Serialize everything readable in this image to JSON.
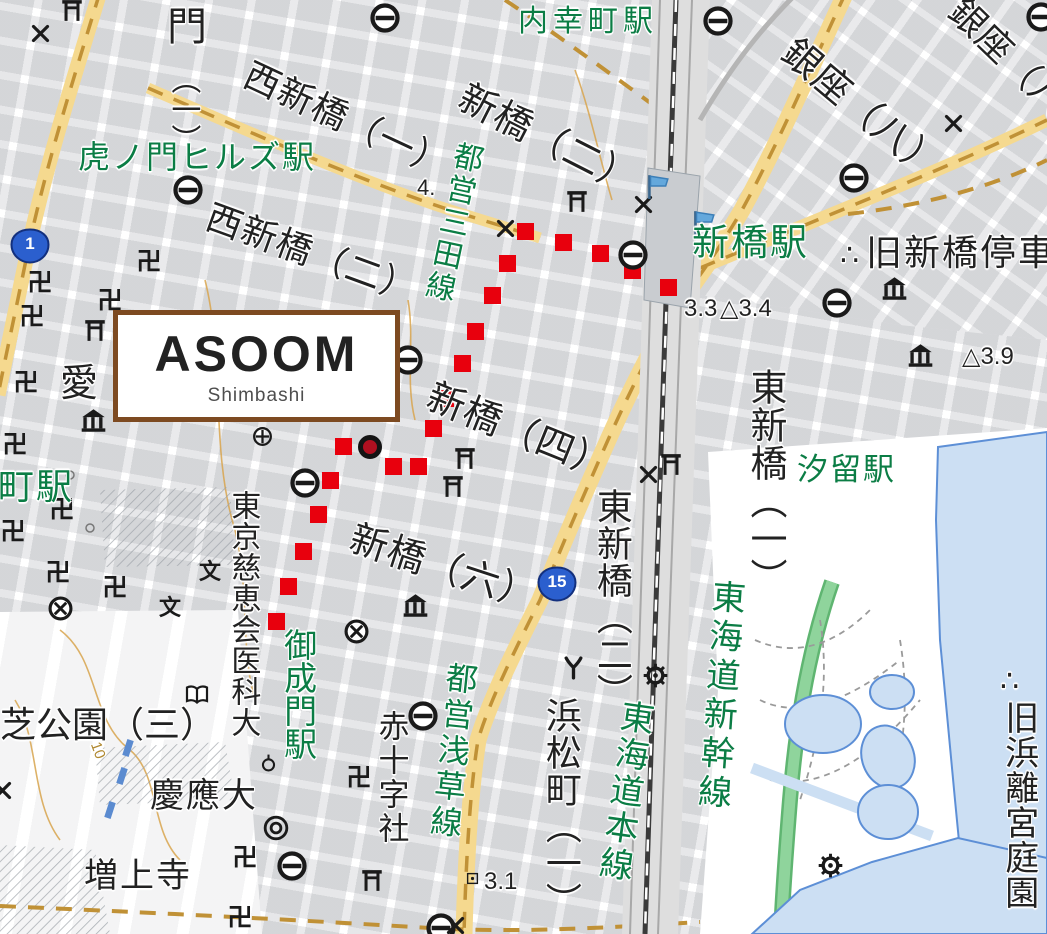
{
  "map": {
    "overlay_card": {
      "title": "ASOOM",
      "subtitle": "Shimbashi"
    },
    "colors": {
      "station_green": "#0b7d45",
      "route_red": "#e8000d",
      "marker_red": "#b01020",
      "road_yellow": "#f5d98f",
      "road_dash_brown": "#c09136",
      "water_fill": "#ccdff3",
      "water_line": "#5d8fd6",
      "green_ribbon": "#8fd49c",
      "box_brown": "#7d4a21",
      "rail_gray": "#dedede"
    },
    "route_shields": [
      {
        "number": "1",
        "x": 10,
        "y": 228
      },
      {
        "number": "15",
        "x": 537,
        "y": 566
      }
    ],
    "destination_marker": {
      "x": 370,
      "y": 447
    },
    "route_dots": [
      [
        668,
        287
      ],
      [
        632,
        270
      ],
      [
        600,
        253
      ],
      [
        563,
        242
      ],
      [
        525,
        231
      ],
      [
        507,
        263
      ],
      [
        492,
        295
      ],
      [
        475,
        331
      ],
      [
        462,
        363
      ],
      [
        445,
        398
      ],
      [
        433,
        428
      ],
      [
        418,
        466
      ],
      [
        393,
        466
      ],
      [
        343,
        446
      ],
      [
        330,
        480
      ],
      [
        318,
        514
      ],
      [
        303,
        551
      ],
      [
        288,
        586
      ],
      [
        276,
        621
      ]
    ],
    "labels": [
      {
        "t": "内幸町駅",
        "x": 518,
        "y": 6,
        "d": "h",
        "s": 30,
        "c": "g",
        "r": 0,
        "ls": 5
      },
      {
        "t": "虎ノ門ヒルズ駅",
        "x": 78,
        "y": 140,
        "d": "h",
        "s": 32,
        "c": "g",
        "r": 0,
        "ls": 2
      },
      {
        "t": "新橋駅",
        "x": 692,
        "y": 223,
        "d": "h",
        "s": 37,
        "c": "g",
        "r": 0,
        "ls": 2
      },
      {
        "t": "汐留駅",
        "x": 797,
        "y": 453,
        "d": "h",
        "s": 31,
        "c": "g",
        "r": 0,
        "ls": 2
      },
      {
        "t": "御成門駅",
        "x": 280,
        "y": 628,
        "d": "v",
        "s": 33,
        "c": "g",
        "r": 0,
        "ls": 0
      },
      {
        "t": "都営三田線",
        "x": 452,
        "y": 138,
        "d": "v",
        "s": 30,
        "c": "g",
        "r": 12,
        "ls": 3
      },
      {
        "t": "都営浅草線",
        "x": 444,
        "y": 660,
        "d": "v",
        "s": 32,
        "c": "g",
        "r": 6,
        "ls": 4
      },
      {
        "t": "東海道新幹線",
        "x": 708,
        "y": 578,
        "d": "v",
        "s": 34,
        "c": "g",
        "r": 4,
        "ls": 5
      },
      {
        "t": "東海道本線",
        "x": 618,
        "y": 697,
        "d": "v",
        "s": 34,
        "c": "g",
        "r": 8,
        "ls": 3
      },
      {
        "t": "町駅",
        "x": -2,
        "y": 468,
        "d": "h",
        "s": 36,
        "c": "g",
        "r": 0,
        "ls": 2
      },
      {
        "t": "門",
        "x": 167,
        "y": 6,
        "d": "h",
        "s": 40,
        "c": "k",
        "r": 0,
        "ls": 0
      },
      {
        "t": "（一）",
        "x": 166,
        "y": 64,
        "d": "v",
        "s": 30,
        "c": "k",
        "r": 0,
        "ls": 0
      },
      {
        "t": "西新橋（一）",
        "x": 254,
        "y": 56,
        "d": "h",
        "s": 36,
        "c": "k",
        "r": 25,
        "ls": 1
      },
      {
        "t": "西新橋（二）",
        "x": 214,
        "y": 198,
        "d": "h",
        "s": 36,
        "c": "k",
        "r": 20,
        "ls": 1
      },
      {
        "t": "新橋（二）",
        "x": 470,
        "y": 78,
        "d": "h",
        "s": 38,
        "c": "k",
        "r": 27,
        "ls": 1
      },
      {
        "t": "新橋（四）",
        "x": 436,
        "y": 377,
        "d": "h",
        "s": 38,
        "c": "k",
        "r": 22,
        "ls": 1
      },
      {
        "t": "新橋（六）",
        "x": 357,
        "y": 519,
        "d": "h",
        "s": 38,
        "c": "k",
        "r": 18,
        "ls": 1
      },
      {
        "t": "東新橋（一）",
        "x": 745,
        "y": 368,
        "d": "v",
        "s": 37,
        "c": "k",
        "r": 0,
        "ls": 1
      },
      {
        "t": "東新橋（二）",
        "x": 592,
        "y": 488,
        "d": "v",
        "s": 36,
        "c": "k",
        "r": 0,
        "ls": 1
      },
      {
        "t": "浜松町（一）",
        "x": 541,
        "y": 697,
        "d": "v",
        "s": 36,
        "c": "k",
        "r": 0,
        "ls": 1
      },
      {
        "t": "東京慈恵会医科大",
        "x": 226,
        "y": 490,
        "d": "v",
        "s": 30,
        "c": "k",
        "r": 0,
        "ls": 1
      },
      {
        "t": "芝公園（三）",
        "x": 0,
        "y": 706,
        "d": "h",
        "s": 36,
        "c": "k",
        "r": 0,
        "ls": 0
      },
      {
        "t": "慶應大",
        "x": 150,
        "y": 778,
        "d": "h",
        "s": 34,
        "c": "k",
        "r": 0,
        "ls": 2
      },
      {
        "t": "増上寺",
        "x": 84,
        "y": 858,
        "d": "h",
        "s": 34,
        "c": "k",
        "r": 0,
        "ls": 2
      },
      {
        "t": "赤十字社",
        "x": 374,
        "y": 710,
        "d": "v",
        "s": 31,
        "c": "k",
        "r": 0,
        "ls": 3
      },
      {
        "t": "銀座（八）",
        "x": 800,
        "y": 32,
        "d": "h",
        "s": 38,
        "c": "k",
        "r": 40,
        "ls": 1
      },
      {
        "t": "銀座（八）",
        "x": 968,
        "y": -8,
        "d": "h",
        "s": 36,
        "c": "k",
        "r": 44,
        "ls": 1
      },
      {
        "t": "愛",
        "x": 60,
        "y": 364,
        "d": "h",
        "s": 38,
        "c": "k",
        "r": 0,
        "ls": 0
      },
      {
        "t": "∴",
        "x": 840,
        "y": 240,
        "d": "h",
        "s": 30,
        "c": "k",
        "r": 0,
        "ls": 0
      },
      {
        "t": "旧新橋停車",
        "x": 866,
        "y": 234,
        "d": "h",
        "s": 36,
        "c": "k",
        "r": 0,
        "ls": 2
      },
      {
        "t": "∴",
        "x": 1000,
        "y": 666,
        "d": "h",
        "s": 30,
        "c": "k",
        "r": 0,
        "ls": 0
      },
      {
        "t": "旧浜離宮庭園",
        "x": 1000,
        "y": 700,
        "d": "v",
        "s": 34,
        "c": "k",
        "r": 0,
        "ls": 1
      },
      {
        "t": "浜松町",
        "x": 995,
        "y": 940,
        "d": "h",
        "s": 1,
        "c": "k",
        "r": 0,
        "ls": 0
      },
      {
        "t": "4.",
        "x": 417,
        "y": 176,
        "d": "h",
        "s": 22,
        "c": "k",
        "r": 0,
        "ls": 0
      },
      {
        "t": "3.3",
        "x": 684,
        "y": 296,
        "d": "h",
        "s": 24,
        "c": "k",
        "r": 0,
        "ls": 0
      },
      {
        "t": "△3.4",
        "x": 720,
        "y": 296,
        "d": "h",
        "s": 24,
        "c": "k",
        "r": 0,
        "ls": 0
      },
      {
        "t": "△3.9",
        "x": 962,
        "y": 344,
        "d": "h",
        "s": 24,
        "c": "k",
        "r": 0,
        "ls": 0
      },
      {
        "t": "3.1",
        "x": 484,
        "y": 869,
        "d": "h",
        "s": 24,
        "c": "k",
        "r": 0,
        "ls": 0
      },
      {
        "t": "10",
        "x": 102,
        "y": 740,
        "d": "h",
        "s": 15,
        "c": "b",
        "r": 70,
        "ls": 0
      }
    ],
    "icons": [
      {
        "type": "metro",
        "x": 385,
        "y": 18
      },
      {
        "type": "metro",
        "x": 188,
        "y": 190
      },
      {
        "type": "metro",
        "x": 718,
        "y": 21
      },
      {
        "type": "metro",
        "x": 1041,
        "y": 17
      },
      {
        "type": "metro",
        "x": 854,
        "y": 178
      },
      {
        "type": "metro",
        "x": 633,
        "y": 255
      },
      {
        "type": "metro",
        "x": 837,
        "y": 303
      },
      {
        "type": "metro",
        "x": 408,
        "y": 360
      },
      {
        "type": "metro",
        "x": 305,
        "y": 483
      },
      {
        "type": "metro",
        "x": 423,
        "y": 716
      },
      {
        "type": "metro",
        "x": 292,
        "y": 866
      },
      {
        "type": "metro",
        "x": 441,
        "y": 928
      },
      {
        "type": "torii",
        "x": 72,
        "y": 10
      },
      {
        "type": "torii",
        "x": 577,
        "y": 201
      },
      {
        "type": "torii",
        "x": 465,
        "y": 458
      },
      {
        "type": "torii",
        "x": 453,
        "y": 486
      },
      {
        "type": "torii",
        "x": 671,
        "y": 464
      },
      {
        "type": "torii",
        "x": 95,
        "y": 330
      },
      {
        "type": "torii",
        "x": 372,
        "y": 880
      },
      {
        "type": "xmark",
        "x": 40,
        "y": 33
      },
      {
        "type": "xmark",
        "x": 505,
        "y": 228
      },
      {
        "type": "xmark",
        "x": 643,
        "y": 204
      },
      {
        "type": "xmark",
        "x": 953,
        "y": 123
      },
      {
        "type": "xmark",
        "x": 648,
        "y": 474
      },
      {
        "type": "xmark",
        "x": 2,
        "y": 790
      },
      {
        "type": "xmark",
        "x": 455,
        "y": 925
      },
      {
        "type": "manji",
        "x": 40,
        "y": 283
      },
      {
        "type": "manji",
        "x": 32,
        "y": 317
      },
      {
        "type": "manji",
        "x": 149,
        "y": 262
      },
      {
        "type": "manji",
        "x": 110,
        "y": 301
      },
      {
        "type": "manji",
        "x": 26,
        "y": 383
      },
      {
        "type": "manji",
        "x": 15,
        "y": 445
      },
      {
        "type": "manji",
        "x": 62,
        "y": 510
      },
      {
        "type": "manji",
        "x": 13,
        "y": 532
      },
      {
        "type": "manji",
        "x": 58,
        "y": 573
      },
      {
        "type": "manji",
        "x": 115,
        "y": 588
      },
      {
        "type": "manji",
        "x": 359,
        "y": 778
      },
      {
        "type": "manji",
        "x": 245,
        "y": 858
      },
      {
        "type": "manji",
        "x": 240,
        "y": 918
      },
      {
        "type": "school",
        "x": 210,
        "y": 572
      },
      {
        "type": "school",
        "x": 170,
        "y": 608
      },
      {
        "type": "police-circle",
        "x": 60,
        "y": 608
      },
      {
        "type": "police-circle",
        "x": 356,
        "y": 631
      },
      {
        "type": "museum",
        "x": 93,
        "y": 420
      },
      {
        "type": "museum",
        "x": 415,
        "y": 605
      },
      {
        "type": "museum",
        "x": 894,
        "y": 288
      },
      {
        "type": "museum",
        "x": 920,
        "y": 355
      },
      {
        "type": "fire-y",
        "x": 573,
        "y": 667
      },
      {
        "type": "gear",
        "x": 655,
        "y": 675
      },
      {
        "type": "gear",
        "x": 830,
        "y": 865
      },
      {
        "type": "flag",
        "x": 657,
        "y": 186
      },
      {
        "type": "flag",
        "x": 703,
        "y": 222
      },
      {
        "type": "double-circle",
        "x": 276,
        "y": 828
      },
      {
        "type": "circle-stem",
        "x": 268,
        "y": 762
      },
      {
        "type": "small-circle",
        "x": 70,
        "y": 475
      },
      {
        "type": "small-circle",
        "x": 90,
        "y": 528
      },
      {
        "type": "book",
        "x": 197,
        "y": 695
      },
      {
        "type": "cross-circle",
        "x": 262,
        "y": 436
      },
      {
        "type": "square-dot",
        "x": 472,
        "y": 878
      },
      {
        "type": "blue-rect",
        "x": 128,
        "y": 748
      },
      {
        "type": "blue-rect",
        "x": 122,
        "y": 776
      },
      {
        "type": "blue-rect",
        "x": 110,
        "y": 810
      }
    ]
  }
}
